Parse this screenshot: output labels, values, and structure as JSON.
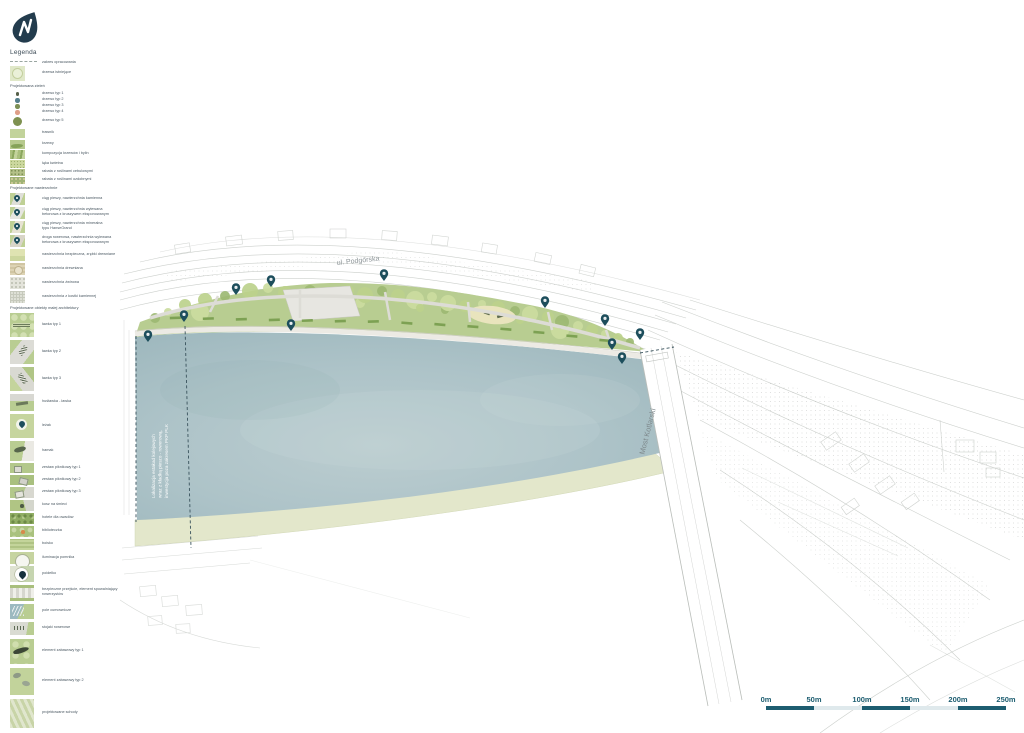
{
  "logo": {
    "name": "drop-logo"
  },
  "legend": {
    "title": "Legenda",
    "rows": [
      {
        "t": "i",
        "y": 61,
        "h": 4,
        "sw": "dash",
        "label": "zakres opracowania"
      },
      {
        "t": "i",
        "y": 66,
        "h": 15,
        "sw": "tree-exist",
        "label": "drzewa istniejące"
      },
      {
        "t": "h",
        "y": 86,
        "text": "Projektowana zieleń"
      },
      {
        "t": "i",
        "y": 92,
        "h": 4,
        "sw": "dot",
        "c": "#566049",
        "d": 3.5,
        "label": "drzewo typ 1"
      },
      {
        "t": "i",
        "y": 98,
        "h": 5,
        "sw": "dot",
        "c": "#557f8d",
        "d": 4.5,
        "label": "drzewo typ 2"
      },
      {
        "t": "i",
        "y": 104,
        "h": 5,
        "sw": "dot",
        "c": "#7c8f55",
        "d": 4.5,
        "label": "drzewo typ 3"
      },
      {
        "t": "i",
        "y": 110,
        "h": 5,
        "sw": "dot",
        "c": "#df9f88",
        "d": 4.5,
        "label": "drzewo typ 4"
      },
      {
        "t": "i",
        "y": 116,
        "h": 10,
        "sw": "dot",
        "c": "#7e9150",
        "d": 9,
        "label": "drzewo typ 5"
      },
      {
        "t": "i",
        "y": 129,
        "h": 9,
        "sw": "lawn",
        "label": "trawnik"
      },
      {
        "t": "i",
        "y": 140,
        "h": 9,
        "sw": "shrub",
        "label": "krzewy"
      },
      {
        "t": "i",
        "y": 150,
        "h": 9,
        "sw": "mix",
        "label": "kompozycja krzewów i bylin"
      },
      {
        "t": "i",
        "y": 160,
        "h": 8,
        "sw": "meadow",
        "label": "łąka kwietna"
      },
      {
        "t": "i",
        "y": 169,
        "h": 7,
        "sw": "bed1",
        "label": "rabata z roślinami cebulowymi"
      },
      {
        "t": "i",
        "y": 177,
        "h": 7,
        "sw": "bed2",
        "label": "rabata z roślinami ozdobnymi"
      },
      {
        "t": "h",
        "y": 188,
        "text": "Projektowane nawierzchnie"
      },
      {
        "t": "i",
        "y": 193,
        "h": 12,
        "sw": "pav-stone",
        "pin": true,
        "label": "ciąg pieszy, nawierzchnia kamienna"
      },
      {
        "t": "i",
        "y": 207,
        "h": 12,
        "sw": "pav-concrete",
        "pin": true,
        "label": "ciąg pieszy, nawierzchnia wylewana",
        "label2": "betonowa z kruszywem eksponowanym"
      },
      {
        "t": "i",
        "y": 221,
        "h": 12,
        "sw": "pav-mineral",
        "pin": true,
        "label": "ciąg pieszy, nawierzchnia mineralna",
        "label2": "typu HanseGrand"
      },
      {
        "t": "i",
        "y": 235,
        "h": 12,
        "sw": "pav-bike",
        "pin": true,
        "label": "droga rowerowa, nawierzchnia wylewana",
        "label2": "betonowa z kruszywem eksponowanym"
      },
      {
        "t": "i",
        "y": 249,
        "h": 12,
        "sw": "pav-safe",
        "label": "nawierzchnia bezpieczna, zrębki drewniane"
      },
      {
        "t": "i",
        "y": 263,
        "h": 12,
        "sw": "pav-wood",
        "label": "nawierzchnia drewniana"
      },
      {
        "t": "i",
        "y": 277,
        "h": 12,
        "sw": "pav-gravel",
        "label": "nawierzchnia żwirowa"
      },
      {
        "t": "i",
        "y": 291,
        "h": 12,
        "sw": "pav-sett",
        "label": "nawierzchnia z kostki kamiennej"
      },
      {
        "t": "h",
        "y": 308,
        "text": "Projektowane obiekty małej architektury"
      },
      {
        "t": "i",
        "y": 313,
        "h": 24,
        "w": 24,
        "sw": "s-lawn-bench",
        "label": "ławka typ 1"
      },
      {
        "t": "i",
        "y": 340,
        "h": 24,
        "w": 24,
        "sw": "s-diag-bench",
        "label": "ławka typ 2"
      },
      {
        "t": "i",
        "y": 367,
        "h": 24,
        "w": 24,
        "sw": "s-diag2",
        "label": "ławka typ 3"
      },
      {
        "t": "i",
        "y": 394,
        "h": 17,
        "w": 24,
        "sw": "s-swing",
        "label": "huśtawka - ławka"
      },
      {
        "t": "i",
        "y": 414,
        "h": 24,
        "w": 24,
        "sw": "s-lezak",
        "label": "leżak"
      },
      {
        "t": "i",
        "y": 441,
        "h": 20,
        "w": 24,
        "sw": "s-hamak",
        "label": "hamak"
      },
      {
        "t": "i",
        "y": 463,
        "h": 10,
        "w": 24,
        "sw": "s-piknik",
        "label": "zestaw piknikowy typ 1"
      },
      {
        "t": "i",
        "y": 475,
        "h": 10,
        "w": 24,
        "sw": "s-piknik2",
        "label": "zestaw piknikowy typ 2"
      },
      {
        "t": "i",
        "y": 487,
        "h": 11,
        "w": 24,
        "sw": "s-piknik3",
        "label": "zestaw piknikowy typ 3"
      },
      {
        "t": "i",
        "y": 500,
        "h": 11,
        "w": 24,
        "sw": "s-kosz",
        "label": "kosz na śmieci"
      },
      {
        "t": "i",
        "y": 513,
        "h": 11,
        "w": 24,
        "sw": "s-hotele",
        "label": "hotele dla owadów"
      },
      {
        "t": "i",
        "y": 526,
        "h": 11,
        "w": 24,
        "sw": "s-biblio",
        "label": "biblioteczka"
      },
      {
        "t": "i",
        "y": 539,
        "h": 11,
        "w": 24,
        "sw": "s-boisko",
        "label": "boisko"
      },
      {
        "t": "i",
        "y": 552,
        "h": 12,
        "w": 24,
        "sw": "s-ilum",
        "label": "iluminacja pomnika"
      },
      {
        "t": "i",
        "y": 566,
        "h": 16,
        "w": 24,
        "sw": "s-poidelko",
        "label": "poidełko"
      },
      {
        "t": "i",
        "y": 585,
        "h": 16,
        "w": 24,
        "sw": "s-przejscie",
        "label": "bezpieczne przejście, element spowalniający",
        "label2": "rowerzystów"
      },
      {
        "t": "i",
        "y": 604,
        "h": 15,
        "w": 24,
        "sw": "s-pole",
        "label": "pole cumownicze"
      },
      {
        "t": "i",
        "y": 622,
        "h": 13,
        "w": 24,
        "sw": "s-stojaki",
        "label": "stojaki rowerowe"
      },
      {
        "t": "i",
        "y": 639,
        "h": 25,
        "w": 24,
        "sw": "s-zabaw1",
        "label": "element zabawowy typ 1"
      },
      {
        "t": "i",
        "y": 668,
        "h": 27,
        "w": 24,
        "sw": "s-zabaw2",
        "label": "element zabawowy typ 2"
      },
      {
        "t": "i",
        "y": 699,
        "h": 29,
        "w": 24,
        "sw": "s-schody",
        "label": "projektowane schody"
      }
    ]
  },
  "plan": {
    "labels": {
      "street": "ul. Podgórska",
      "bridge": "Most Kotlarski",
      "river_note_1": "Lokalizacja estakad kolejowych",
      "river_note_2": "wraz z kładką pieszo - rowerową,",
      "river_note_3": "inwestycja poza zakresem PKP PLK"
    },
    "colors": {
      "accent_teal": "#1d5d70",
      "marker": "#1d4e5c",
      "river": "#a9c0c5",
      "lawn": "#b8cd91",
      "bank": "#e3e7cb"
    }
  },
  "scalebar": {
    "labels": [
      "0m",
      "50m",
      "100m",
      "150m",
      "200m",
      "250m"
    ],
    "dark": "#1d5d70",
    "light": "#dfe9ec"
  }
}
